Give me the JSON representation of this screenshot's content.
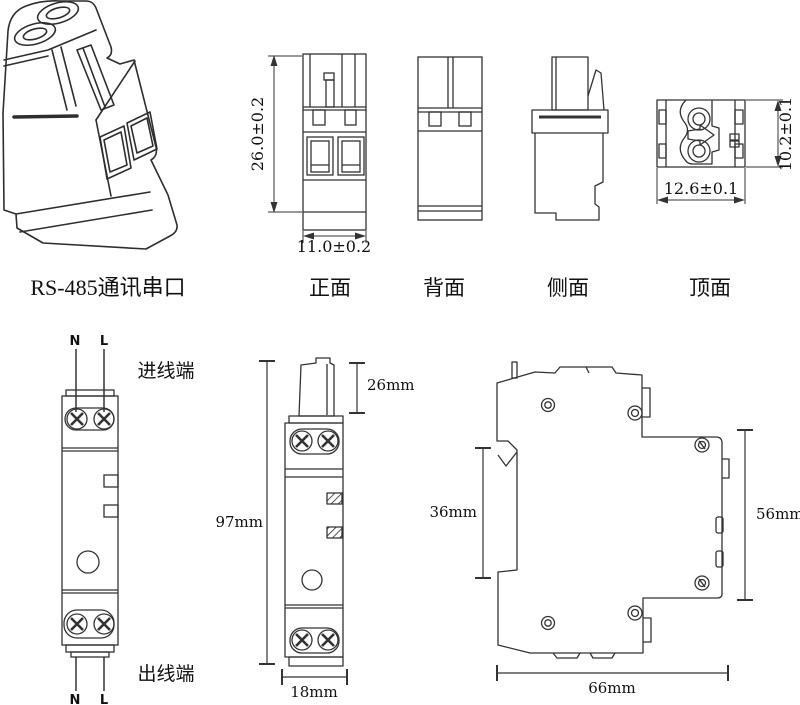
{
  "colors": {
    "background": "#ffffff",
    "line": "#333333",
    "text": "#111111"
  },
  "iso_view": {
    "label": "RS-485通讯串口"
  },
  "ortho_views": {
    "front": {
      "label": "正面",
      "height_dim": "26.0±0.2",
      "width_dim": "11.0±0.2"
    },
    "back": {
      "label": "背面"
    },
    "side": {
      "label": "侧面"
    },
    "top": {
      "label": "顶面",
      "height_dim": "10.2±0.1",
      "width_dim": "12.6±0.1"
    }
  },
  "device_views": {
    "front": {
      "top_wire_n": "N",
      "top_wire_l": "L",
      "bottom_wire_n": "N",
      "bottom_wire_l": "L",
      "inlet_label": "进线端",
      "outlet_label": "出线端"
    },
    "middle": {
      "height_dim": "97mm",
      "plug_height_dim": "26mm",
      "width_dim": "18mm"
    },
    "side": {
      "rail_dim": "36mm",
      "height_dim": "56mm",
      "depth_dim": "66mm"
    }
  }
}
